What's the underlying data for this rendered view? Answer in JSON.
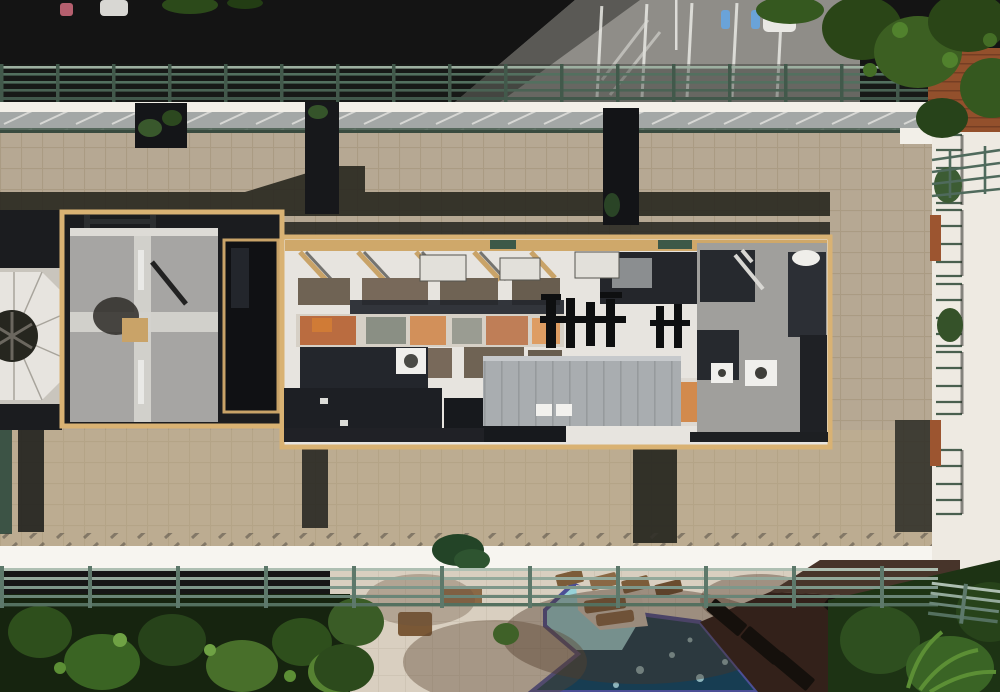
{
  "meta": {
    "title": "Aerial drone photograph of condominium rooftop",
    "kind": "top-down exterior photo",
    "no_visible_text": true
  },
  "scene": {
    "description": "Top-down aerial view of a long condominium building rooftop. Tan tiled roof deck with green perimeter railings and white parapets; a recessed central mechanical well holds gray membrane roofing, taupe paver panels, rust-stained air handler units, black piping and a gray standing-seam metal roof; a white octagonal cupola vent sits at the left edge. Above the building: a shaded parking lot with white stall lines, accessible-parking symbols, a parked white car and tree canopy. Below: pool deck pavers, an angular swimming pool with violet tile border (bright aqua shallows, deep navy water), lounge chairs, a dark shaded wood deck and dense green trees with palm fronds. A sunlit white building wing with stacked balconies and terracotta roof sections runs along the right edge.",
    "elements": [
      "parking-lot",
      "parking-stall-lines",
      "accessible-parking-symbols",
      "white-car",
      "light-pole",
      "tree-canopy-top-right",
      "north-perimeter-railing",
      "white-parapet",
      "skylight-strip",
      "tan-tile-roof-deck",
      "stair-recesses",
      "cast-shadows",
      "cupola-vent",
      "membrane-roof-panel",
      "mechanical-well",
      "taupe-paver-panels",
      "rusted-ahu-units",
      "black-piping",
      "metal-roof",
      "roof-vents",
      "south-parapet",
      "south-perimeter-railing",
      "pool-deck",
      "swimming-pool",
      "pool-tile-border",
      "deck-peninsula",
      "lounge-chairs",
      "green-umbrella",
      "shade-shadows",
      "trees-bottom-left",
      "dark-wood-deck",
      "palm-fronds",
      "right-building-wing",
      "balconies",
      "balcony-plants",
      "terracotta-roofs"
    ]
  },
  "palette": {
    "ground_shadow": "#141414",
    "parking_lit": "#8f8d88",
    "parking_line": "#e9e9e4",
    "handicap_blue": "#6aa3d8",
    "tree_dark": "#1d3014",
    "tree_mid": "#35581f",
    "tree_light": "#5c8f35",
    "rail_green": "#4f6a5c",
    "rail_light": "#93a99b",
    "parapet_white": "#f2efe8",
    "tile_tan": "#b6a893",
    "tile_grout": "#a08f77",
    "wall_tan": "#d9b273",
    "well_dark": "#1b1c1f",
    "membrane": "#a6a5a3",
    "membrane_seam": "#d3d2ce",
    "panel_taupe": "#6f6354",
    "roof_white": "#e7e4df",
    "rust": "#b55b28",
    "rust_light": "#d07b36",
    "metal_roof": "#a9adb0",
    "shadow_navy": "#23262d",
    "pool_deep": "#173d52",
    "pool_shallow": "#97d2d8",
    "pool_border": "#4c4f96",
    "deck": "#d9cfc0",
    "deck_shadow": "#97846e",
    "furniture_brown": "#7c5c39",
    "dark_deck": "#33211a",
    "chair_dark": "#15100c",
    "side_white": "#eeeae2",
    "terracotta": "#93502c",
    "cone_white": "#e7e4df",
    "skylight_gray": "#a3a7a6"
  }
}
